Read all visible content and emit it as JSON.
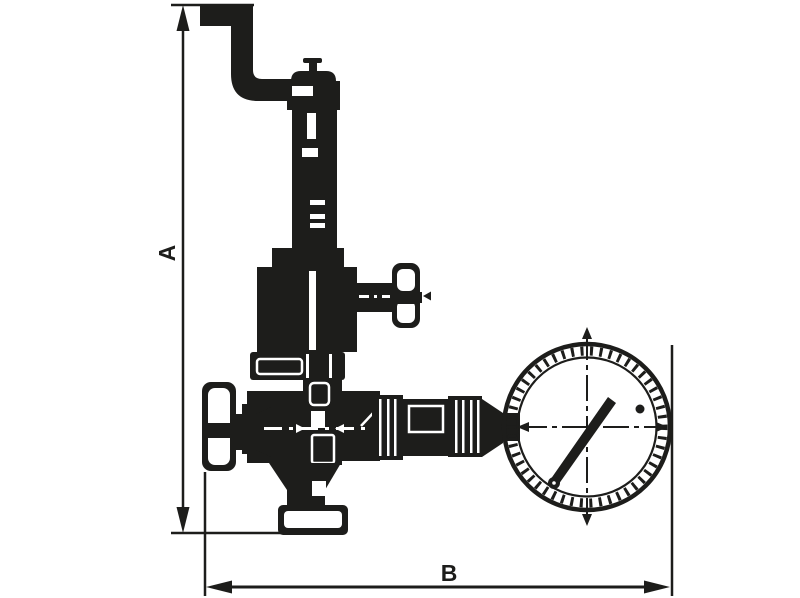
{
  "diagram": {
    "ink_color": "#1d1d1b",
    "background_color": "#ffffff",
    "dimensions": {
      "vertical": {
        "label": "A"
      },
      "horizontal": {
        "label": "B"
      }
    }
  }
}
